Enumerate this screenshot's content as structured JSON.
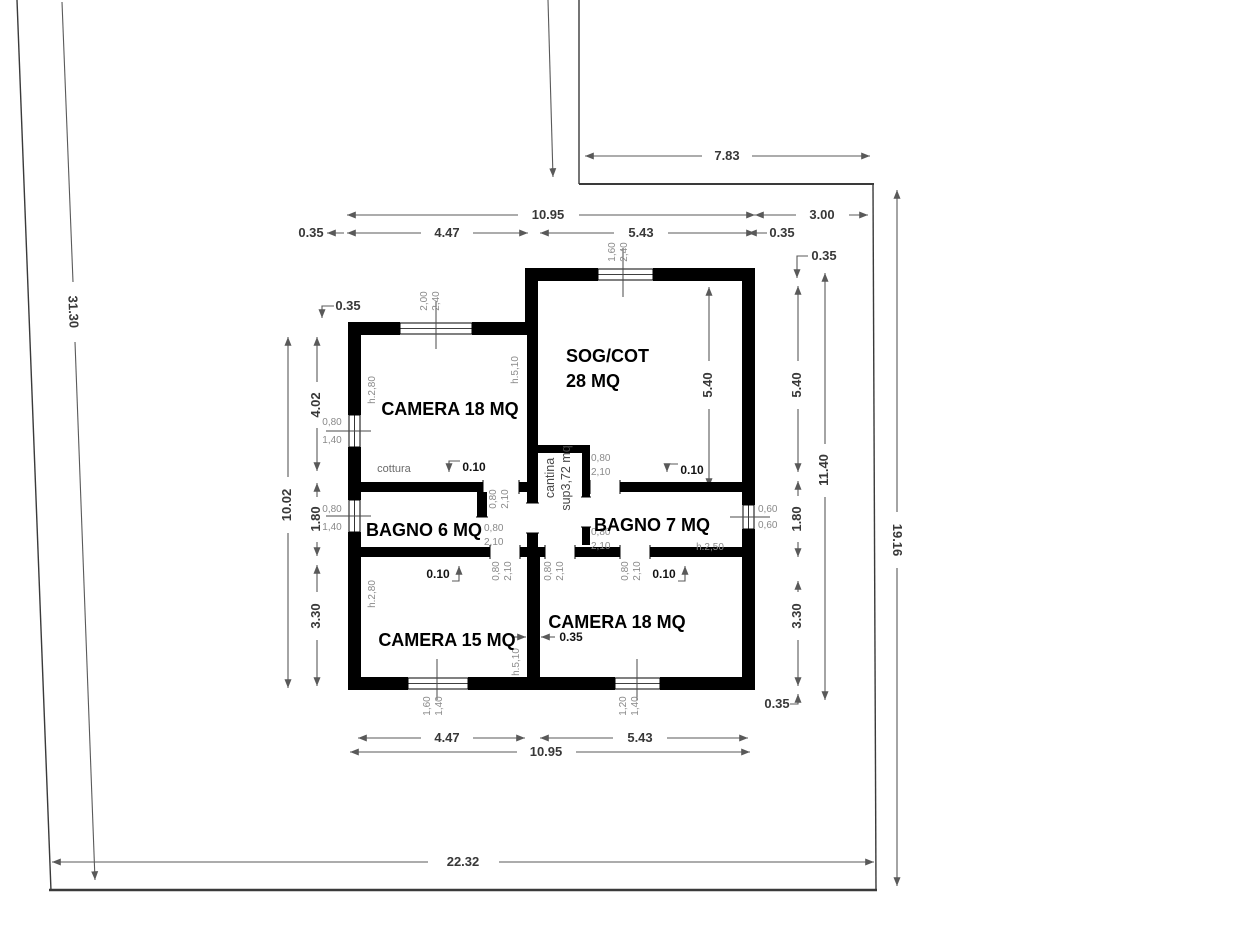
{
  "plan": {
    "site": {
      "top": "7.83",
      "left": "31.30",
      "right": "19.16",
      "bottom": "22.32"
    },
    "top": {
      "total": "10.95",
      "right": "3.00",
      "wall_left": "0.35",
      "room_left": "4.47",
      "room_right": "5.43",
      "wall_right": "0.35",
      "wall_right2": "0.35"
    },
    "left": {
      "total": "10.02",
      "camera": "4.02",
      "bagno": "1.80",
      "camera15": "3.30",
      "wall_top": "0.35"
    },
    "right": {
      "sog_inner": "5.40",
      "sog": "5.40",
      "bagno": "1.80",
      "camera": "3.30",
      "total": "11.40",
      "wall_bottom": "0.35"
    },
    "bottom": {
      "room_left": "4.47",
      "room_right": "5.43",
      "total": "10.95"
    },
    "rooms": {
      "camera_top": "CAMERA 18 MQ",
      "sog1": "SOG/COT",
      "sog2": "28 MQ",
      "bagno6": "BAGNO 6 MQ",
      "bagno7": "BAGNO 7 MQ",
      "camera15": "CAMERA 15 MQ",
      "camera18": "CAMERA 18 MQ",
      "cottura": "cottura",
      "cantina1": "cantina",
      "cantina2": "sup3,72 mq"
    },
    "heights": {
      "h280": "h.2,80",
      "h510": "h.5,10",
      "h250": "h.2,50"
    },
    "windows": {
      "top_left_w": "2,00",
      "top_left_h": "2,40",
      "top_right_w": "1,60",
      "top_right_h": "2,40",
      "left_w": "0,80",
      "left_h": "1,40",
      "right_w": "0,60",
      "right_h": "0,60",
      "bottom_left_w": "1,60",
      "bottom_left_h": "1,40",
      "bottom_right_w": "1,20",
      "bottom_right_h": "1,40"
    },
    "doors": {
      "width": "0,80",
      "height": "2,10"
    },
    "walls": {
      "thin": "0.10",
      "mid": "0.35"
    }
  }
}
